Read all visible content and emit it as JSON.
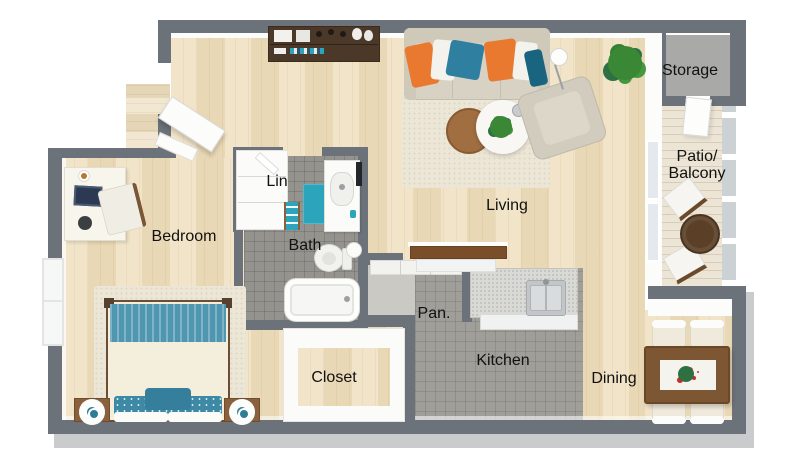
{
  "plan": {
    "type": "3D apartment floor plan, top-down view",
    "rooms": {
      "storage": "Storage",
      "patio": "Patio/\nBalcony",
      "living": "Living",
      "bedroom": "Bedroom",
      "linen": "Lin",
      "bath": "Bath",
      "pantry": "Pan.",
      "closet": "Closet",
      "kitchen": "Kitchen",
      "dining": "Dining"
    },
    "colors": {
      "wall": "#6c727a",
      "wall_base": "#c9cbcd",
      "wood_floor": "#ecdcbd",
      "bath_tile": "#95938e",
      "kitchen_tile": "#a09e99",
      "storage_floor": "#a9a9a7",
      "accent_teal": "#3583a0",
      "accent_orange": "#e9792e",
      "label_text": "#111111"
    }
  }
}
